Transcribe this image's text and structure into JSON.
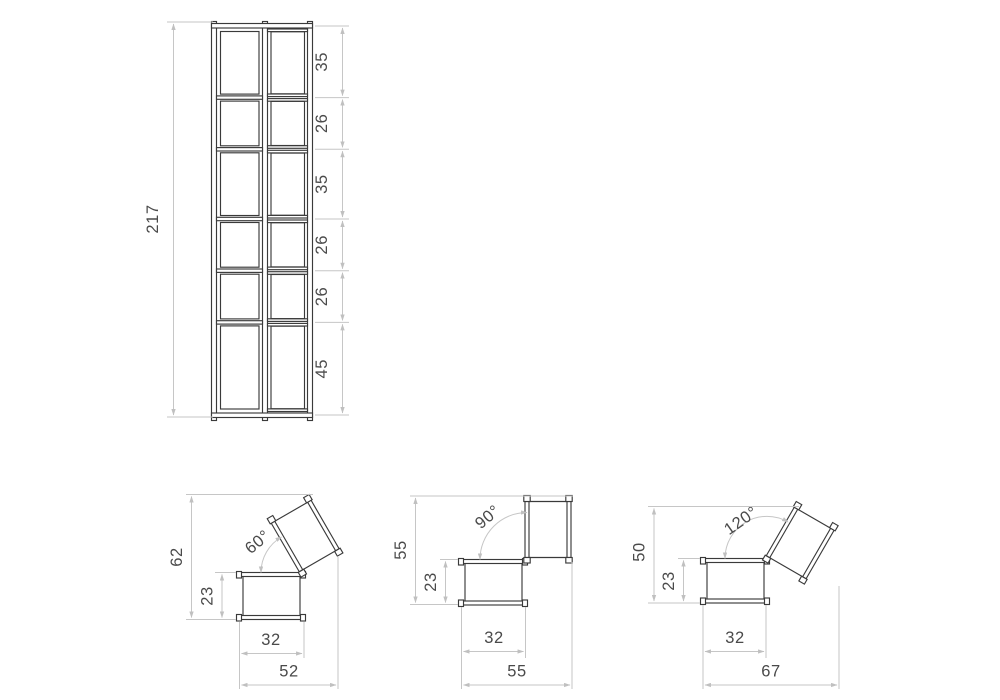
{
  "drawing": {
    "title": "furniture-dimension-drawing",
    "colors": {
      "line": "#3a3a3a",
      "dimension": "#c6c6c6",
      "text": "#4a4a4a",
      "background": "#ffffff"
    },
    "tower": {
      "total_height": "217",
      "segments": [
        "35",
        "26",
        "35",
        "26",
        "26",
        "45"
      ]
    },
    "seats": [
      {
        "angle": "60°",
        "total_height": "62",
        "seat_height": "23",
        "seat_width": "32",
        "total_width": "52"
      },
      {
        "angle": "90°",
        "total_height": "55",
        "seat_height": "23",
        "seat_width": "32",
        "total_width": "55"
      },
      {
        "angle": "120°",
        "total_height": "50",
        "seat_height": "23",
        "seat_width": "32",
        "total_width": "67"
      }
    ]
  }
}
